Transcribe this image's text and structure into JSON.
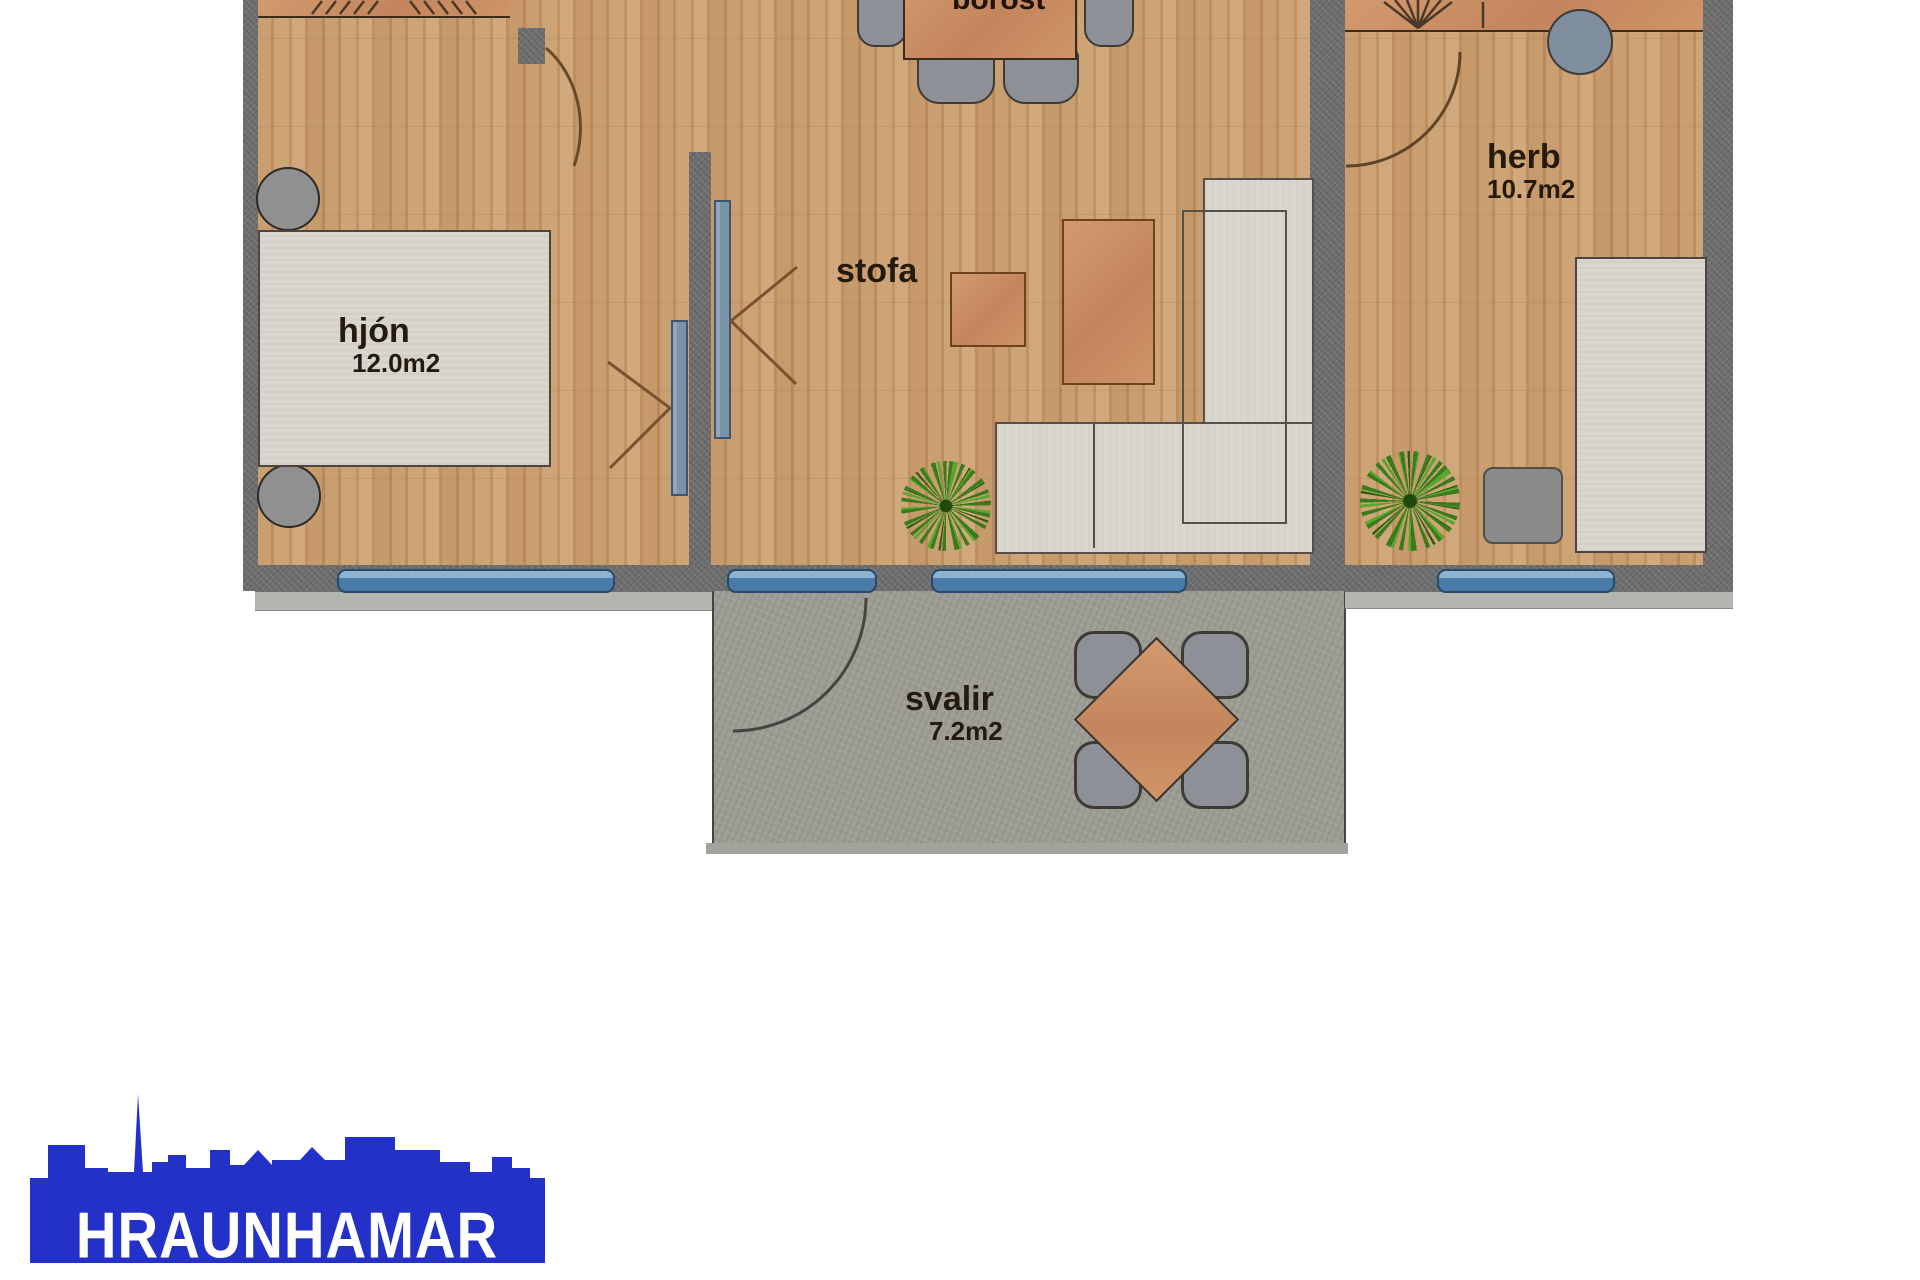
{
  "plan": {
    "rooms": {
      "hjon": {
        "label": "hjón",
        "area": "12.0m2"
      },
      "stofa": {
        "label": "stofa"
      },
      "dining": {
        "label": "borðst"
      },
      "herb": {
        "label": "herb",
        "area": "10.7m2"
      },
      "balcony": {
        "label": "svalir",
        "area": "7.2m2"
      }
    },
    "colors": {
      "wood_floor": "#c59a6c",
      "wall_gray": "#6d6d6d",
      "balcony_concrete": "#9d9d95",
      "window_blue": "#497aa8",
      "furniture_orange": "#c4855c",
      "sofa_bed_gray": "#d8d6cf",
      "chair_gray": "#8d9097",
      "plant_green": "#3c7a1e",
      "label_text": "#241a0e"
    }
  },
  "logo": {
    "text": "HRAUNHAMAR",
    "color": "#2431c9"
  }
}
